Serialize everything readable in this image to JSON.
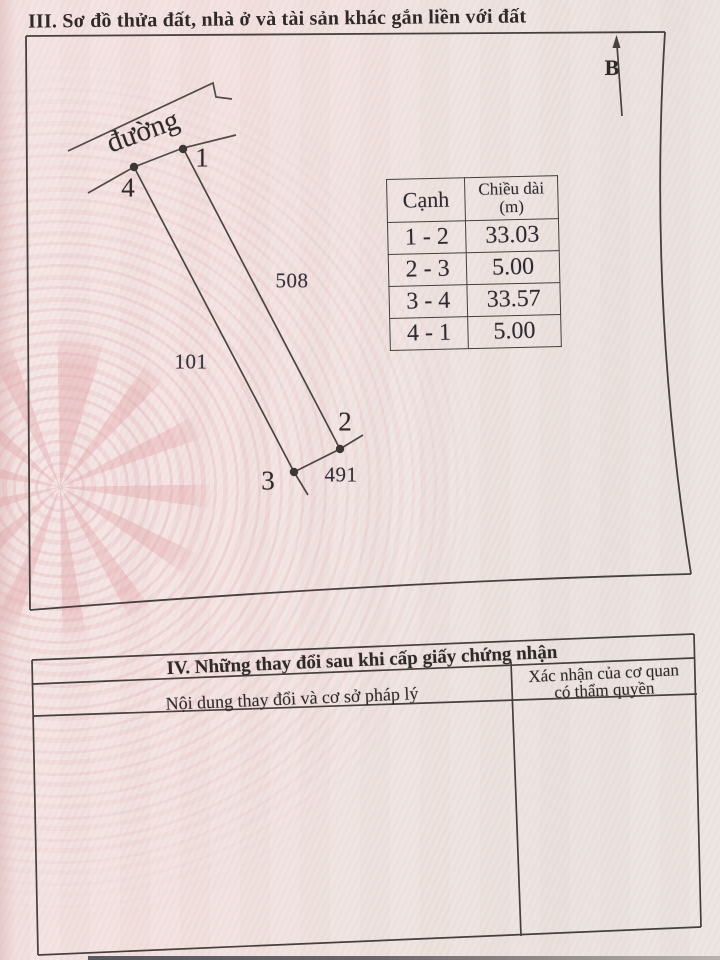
{
  "section3": {
    "title": "III. Sơ đồ thửa đất, nhà ở và tài sản khác gắn liền với đất",
    "north_label": "B",
    "road_label": "đường",
    "vertices": {
      "v1": "1",
      "v2": "2",
      "v3": "3",
      "v4": "4"
    },
    "adjacent_plots": {
      "left": "101",
      "right": "508",
      "bottom": "491"
    },
    "measure_table": {
      "col_edge": "Cạnh",
      "col_length": "Chiều dài",
      "col_length_unit": "(m)",
      "rows": [
        {
          "edge": "1 - 2",
          "length": "33.03"
        },
        {
          "edge": "2 - 3",
          "length": "5.00"
        },
        {
          "edge": "3 - 4",
          "length": "33.57"
        },
        {
          "edge": "4 - 1",
          "length": "5.00"
        }
      ]
    }
  },
  "section4": {
    "title": "IV. Những thay đổi sau khi cấp giấy chứng nhận",
    "col_content": "Nội dung thay đổi và cơ sở pháp lý",
    "col_confirm_line1": "Xác nhận của cơ quan",
    "col_confirm_line2": "có thẩm quyền"
  }
}
